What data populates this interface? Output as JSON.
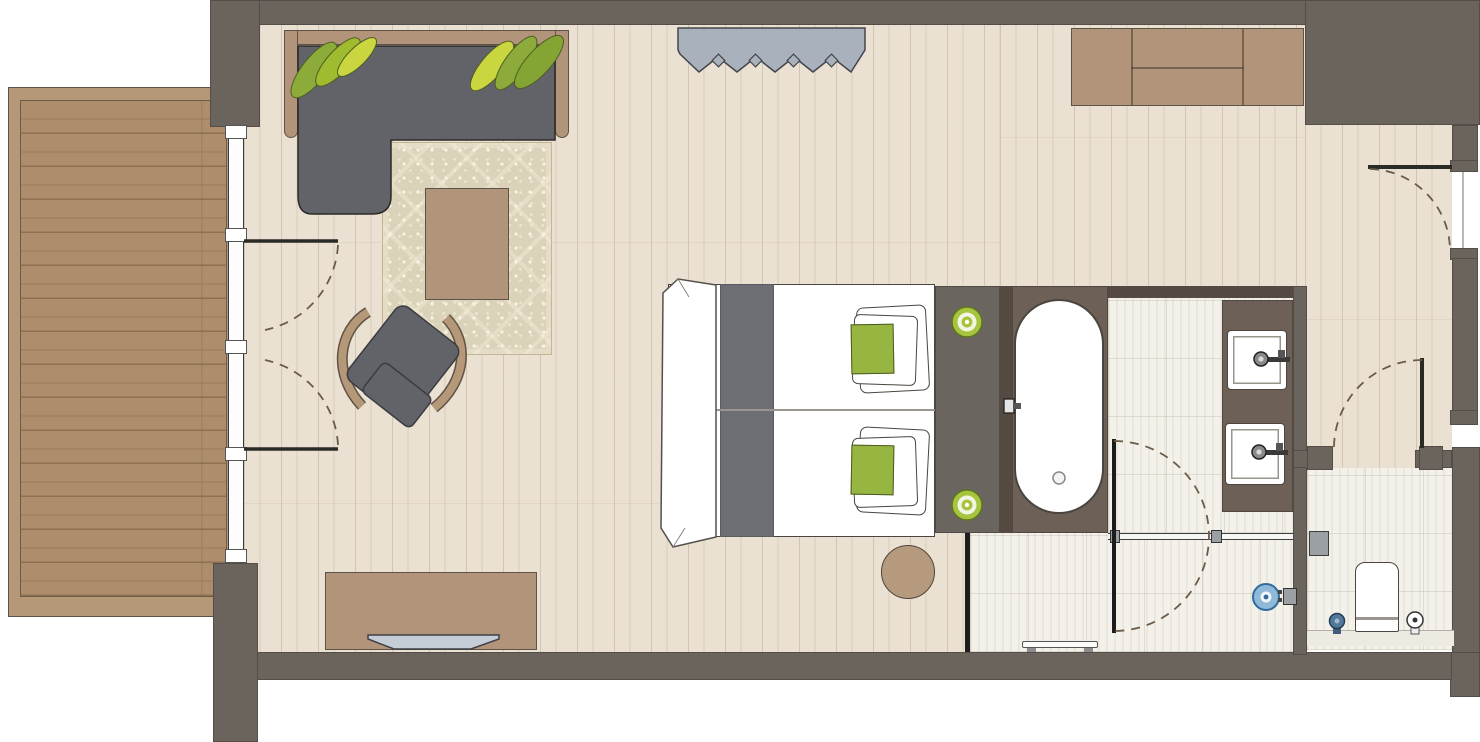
{
  "document": {
    "type": "architectural floor plan",
    "description": "Top-down hotel guest room floor plan with balcony, living area, twin bed, bathroom, walk-in shower, separate WC and entry hall",
    "visible_text": []
  },
  "palette": {
    "wall": "#6a645c",
    "wall_dark": "#554a41",
    "surround": "#6d6057",
    "headboard_panel": "#6b6560",
    "wood_floor": "#eae1d2",
    "deck": "#ad8d6b",
    "deck_frame": "#b49877",
    "tan_furniture": "#b2947b",
    "tan_border": "#5f5347",
    "sofa_gray": "#626369",
    "runner_gray": "#6d6e74",
    "leaf_green_1": "#8cab3a",
    "leaf_green_2": "#9fbb2f",
    "leaf_green_3": "#c9d63f",
    "leaf_green_4": "#84a434",
    "cushion_green": "#97b541",
    "lamp_green": "#a6c43d",
    "rug_beige": "#dbd2ba",
    "curtain_gray_blue": "#a9b2bc",
    "tile": "#f3f1ea",
    "white": "#ffffff",
    "glass_black": "#1d1d1d",
    "door_line": "#2b2b26",
    "arc_dash": "#6b5b48",
    "drain_blue": "#8fb9d8",
    "drain_blue_ring": "#2f6c9c",
    "tp_holder_blue": "#54779c",
    "tv_gray": "#c5ced6",
    "pouf_tan": "#b59a7e",
    "fixture_gray": "#9aa0a3"
  },
  "rooms": [
    {
      "name": "balcony",
      "floor": "horizontal wood decking",
      "items": [
        "deck",
        "sliding glass wall",
        "double french doors"
      ]
    },
    {
      "name": "living-bedroom",
      "floor": "vertical plank wood",
      "items": [
        "corner sofa with wood frame",
        "two plant leaf clusters",
        "patterned rug",
        "coffee table",
        "lounge chair",
        "sideboard",
        "tv",
        "curtain",
        "wardrobe",
        "twin bed",
        "4 pillows",
        "2 green cushions",
        "bed runner",
        "headboard panel",
        "2 round reading lights",
        "round pouf"
      ]
    },
    {
      "name": "bathroom",
      "floor": "light tile",
      "items": [
        "bathtub in dark surround",
        "tub faucet",
        "tub drain",
        "double vanity",
        "2 sinks with faucets",
        "glass shower partition",
        "pivot door"
      ]
    },
    {
      "name": "shower",
      "floor": "light tile",
      "items": [
        "glass screen",
        "round floor drain",
        "shower control",
        "drain bench"
      ]
    },
    {
      "name": "wc",
      "floor": "light tile",
      "items": [
        "toilet",
        "toilet paper holder",
        "toilet brush",
        "wall box",
        "door with swing arc"
      ]
    },
    {
      "name": "entry-hall",
      "floor": "vertical plank wood",
      "items": [
        "entrance door with swing arc",
        "threshold"
      ]
    }
  ],
  "counts": {
    "doors_with_arcs": 5,
    "sinks": 2,
    "reading_lights": 2,
    "plant_clusters": 2
  }
}
